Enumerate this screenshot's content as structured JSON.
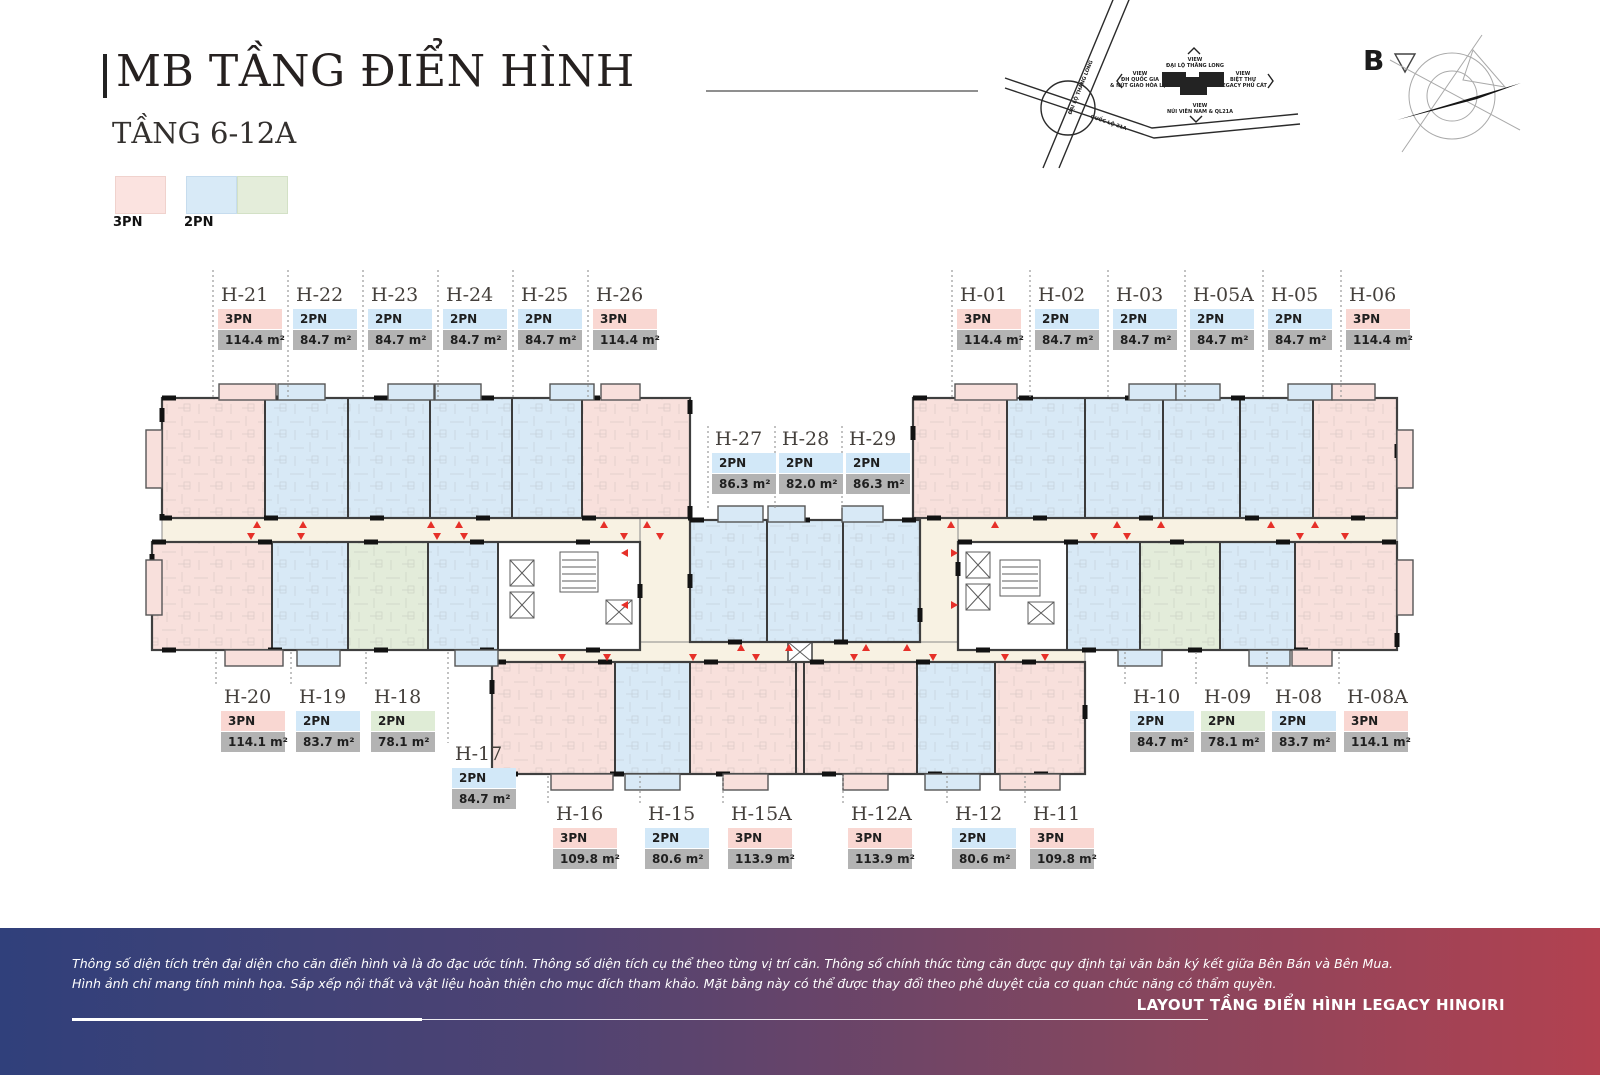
{
  "page_title": "MB TẦNG ĐIỂN HÌNH",
  "subtitle": "TẦNG 6-12A",
  "legend": {
    "items": [
      {
        "label": "3PN",
        "color": "#fbe3e0"
      },
      {
        "label": "2PN",
        "color": "#d8eaf7"
      },
      {
        "label": "",
        "color": "#e4edda"
      }
    ]
  },
  "colors": {
    "unit_3pn": "#f8e0dc",
    "unit_2pn": "#d8e9f6",
    "unit_2pn_small": "#e3ecda",
    "corridor": "#f8f2e3",
    "area_badge": "#b3b3b3",
    "marker_red": "#e63029",
    "footer_left": "#30407b",
    "footer_right": "#b24150"
  },
  "site_map": {
    "road1": "ĐẠI LỘ THĂNG LONG",
    "road2": "QUỐC LỘ 21A",
    "views": {
      "top": [
        "VIEW",
        "ĐẠI LỘ THĂNG LONG"
      ],
      "left": [
        "VIEW",
        "ĐH QUỐC GIA",
        "& NÚT GIAO HÒA LẠC"
      ],
      "right": [
        "VIEW",
        "BIỆT THỰ",
        "LEGACY PHÚ CÁT"
      ],
      "bottom": [
        "VIEW",
        "NÚI VIÊN NAM & QL21A"
      ]
    }
  },
  "compass": {
    "letter": "B"
  },
  "units": [
    {
      "id": "H-21",
      "bedrooms": "3PN",
      "area": "114.4 m²",
      "cat": "pink",
      "lx": 218,
      "ly": 286
    },
    {
      "id": "H-22",
      "bedrooms": "2PN",
      "area": "84.7 m²",
      "cat": "blue",
      "lx": 293,
      "ly": 286
    },
    {
      "id": "H-23",
      "bedrooms": "2PN",
      "area": "84.7 m²",
      "cat": "blue",
      "lx": 368,
      "ly": 286
    },
    {
      "id": "H-24",
      "bedrooms": "2PN",
      "area": "84.7 m²",
      "cat": "blue",
      "lx": 443,
      "ly": 286
    },
    {
      "id": "H-25",
      "bedrooms": "2PN",
      "area": "84.7 m²",
      "cat": "blue",
      "lx": 518,
      "ly": 286
    },
    {
      "id": "H-26",
      "bedrooms": "3PN",
      "area": "114.4 m²",
      "cat": "pink",
      "lx": 593,
      "ly": 286
    },
    {
      "id": "H-01",
      "bedrooms": "3PN",
      "area": "114.4 m²",
      "cat": "pink",
      "lx": 957,
      "ly": 286
    },
    {
      "id": "H-02",
      "bedrooms": "2PN",
      "area": "84.7 m²",
      "cat": "blue",
      "lx": 1035,
      "ly": 286
    },
    {
      "id": "H-03",
      "bedrooms": "2PN",
      "area": "84.7 m²",
      "cat": "blue",
      "lx": 1113,
      "ly": 286
    },
    {
      "id": "H-05A",
      "bedrooms": "2PN",
      "area": "84.7 m²",
      "cat": "blue",
      "lx": 1190,
      "ly": 286
    },
    {
      "id": "H-05",
      "bedrooms": "2PN",
      "area": "84.7 m²",
      "cat": "blue",
      "lx": 1268,
      "ly": 286
    },
    {
      "id": "H-06",
      "bedrooms": "3PN",
      "area": "114.4 m²",
      "cat": "pink",
      "lx": 1346,
      "ly": 286
    },
    {
      "id": "H-27",
      "bedrooms": "2PN",
      "area": "86.3 m²",
      "cat": "blue",
      "lx": 712,
      "ly": 430
    },
    {
      "id": "H-28",
      "bedrooms": "2PN",
      "area": "82.0 m²",
      "cat": "blue",
      "lx": 779,
      "ly": 430
    },
    {
      "id": "H-29",
      "bedrooms": "2PN",
      "area": "86.3 m²",
      "cat": "blue",
      "lx": 846,
      "ly": 430
    },
    {
      "id": "H-20",
      "bedrooms": "3PN",
      "area": "114.1 m²",
      "cat": "pink",
      "lx": 221,
      "ly": 688
    },
    {
      "id": "H-19",
      "bedrooms": "2PN",
      "area": "83.7 m²",
      "cat": "blue",
      "lx": 296,
      "ly": 688
    },
    {
      "id": "H-18",
      "bedrooms": "2PN",
      "area": "78.1 m²",
      "cat": "green",
      "lx": 371,
      "ly": 688
    },
    {
      "id": "H-17",
      "bedrooms": "2PN",
      "area": "84.7 m²",
      "cat": "blue",
      "lx": 452,
      "ly": 745
    },
    {
      "id": "H-16",
      "bedrooms": "3PN",
      "area": "109.8 m²",
      "cat": "pink",
      "lx": 553,
      "ly": 805
    },
    {
      "id": "H-15",
      "bedrooms": "2PN",
      "area": "80.6 m²",
      "cat": "blue",
      "lx": 645,
      "ly": 805
    },
    {
      "id": "H-15A",
      "bedrooms": "3PN",
      "area": "113.9 m²",
      "cat": "pink",
      "lx": 728,
      "ly": 805
    },
    {
      "id": "H-12A",
      "bedrooms": "3PN",
      "area": "113.9 m²",
      "cat": "pink",
      "lx": 848,
      "ly": 805
    },
    {
      "id": "H-12",
      "bedrooms": "2PN",
      "area": "80.6 m²",
      "cat": "blue",
      "lx": 952,
      "ly": 805
    },
    {
      "id": "H-11",
      "bedrooms": "3PN",
      "area": "109.8 m²",
      "cat": "pink",
      "lx": 1030,
      "ly": 805
    },
    {
      "id": "H-10",
      "bedrooms": "2PN",
      "area": "84.7 m²",
      "cat": "blue",
      "lx": 1130,
      "ly": 688
    },
    {
      "id": "H-09",
      "bedrooms": "2PN",
      "area": "78.1 m²",
      "cat": "green",
      "lx": 1201,
      "ly": 688
    },
    {
      "id": "H-08",
      "bedrooms": "2PN",
      "area": "83.7 m²",
      "cat": "blue",
      "lx": 1272,
      "ly": 688
    },
    {
      "id": "H-08A",
      "bedrooms": "3PN",
      "area": "114.1 m²",
      "cat": "pink",
      "lx": 1344,
      "ly": 688
    }
  ],
  "footer": {
    "disclaimer1": "Thông số diện tích trên đại diện cho căn điển hình và là đo đạc ước tính. Thông số diện tích cụ thể theo từng vị trí căn. Thông số chính thức từng căn được quy định tại văn bản ký kết giữa Bên Bán và Bên Mua.",
    "disclaimer2": "Hình ảnh chỉ mang tính minh họa. Sắp xếp nội thất và vật liệu hoàn thiện cho mục đích tham khảo. Mặt bằng này có thể được thay đổi theo phê duyệt của cơ quan chức năng có thẩm quyền.",
    "brand": "LAYOUT TẦNG ĐIỂN HÌNH LEGACY HINOIRI"
  }
}
